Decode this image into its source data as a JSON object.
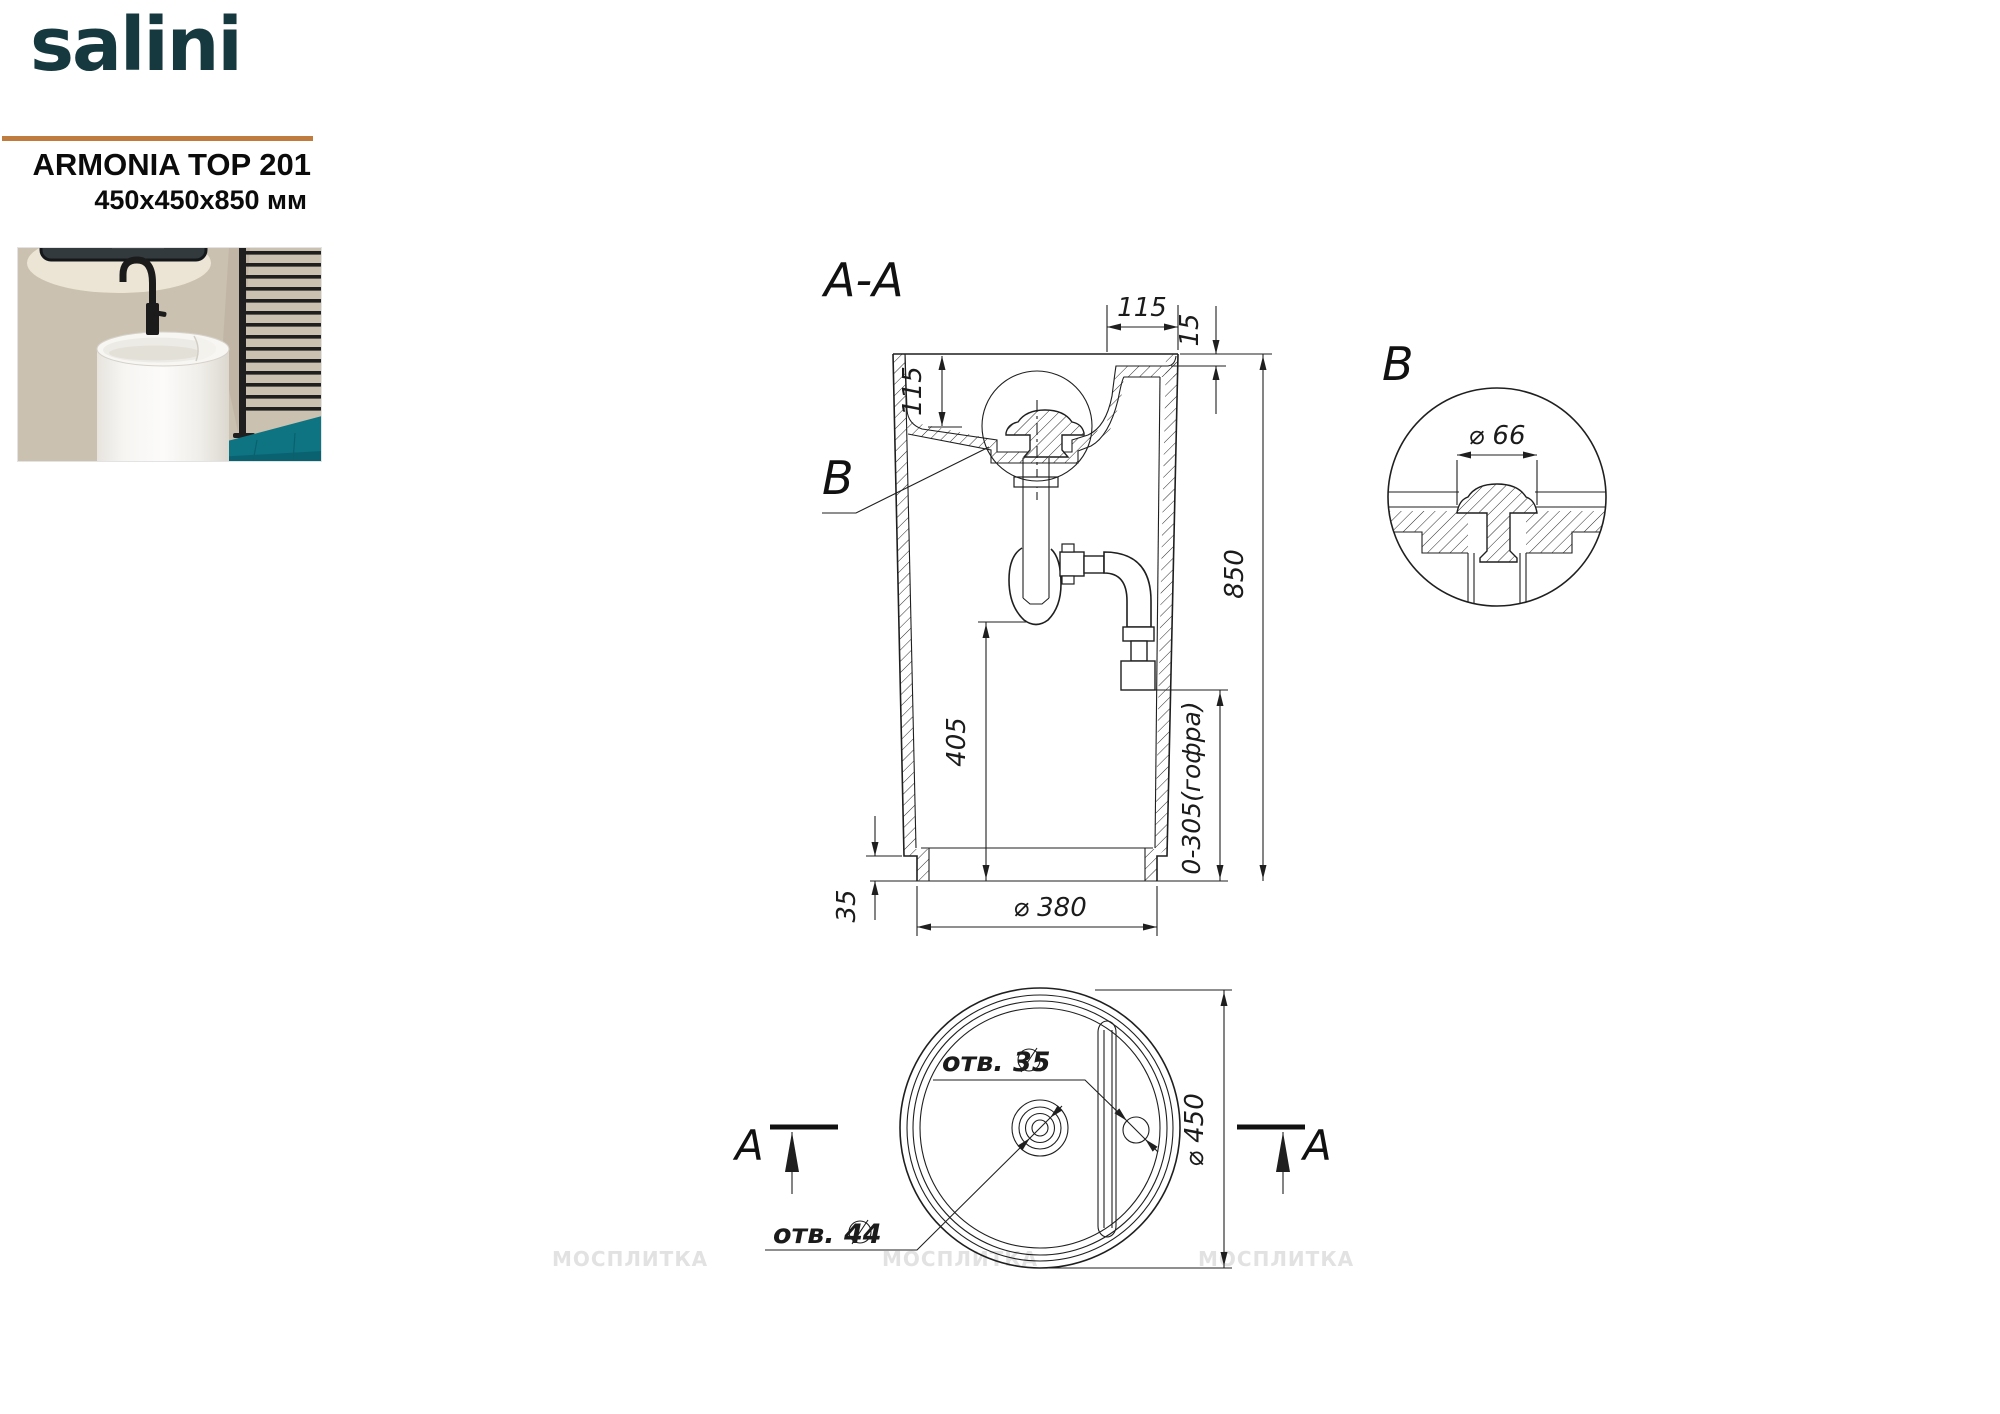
{
  "header": {
    "logo": "salini",
    "model": "ARMONIA TOP 201",
    "dimensions": "450x450x850 мм"
  },
  "drawing": {
    "section": {
      "title": "A-A",
      "detail_label": "B",
      "dim_deck_width": "115",
      "dim_deck_recess": "15",
      "dim_bowl_depth": "115",
      "dim_total_height": "850",
      "dim_trap_height": "405",
      "dim_outlet_range": "0-305(гофра)",
      "dim_foot_height": "35",
      "dim_base_diameter": "⌀ 380"
    },
    "detail": {
      "title": "B",
      "dim_drain_diameter": "⌀ 66"
    },
    "plan": {
      "section_marker": "A",
      "faucet_hole": "отв. 35",
      "drain_hole": "отв. 44",
      "dim_outer_diameter": "⌀ 450"
    },
    "watermark": "МОСПЛИТКА"
  }
}
